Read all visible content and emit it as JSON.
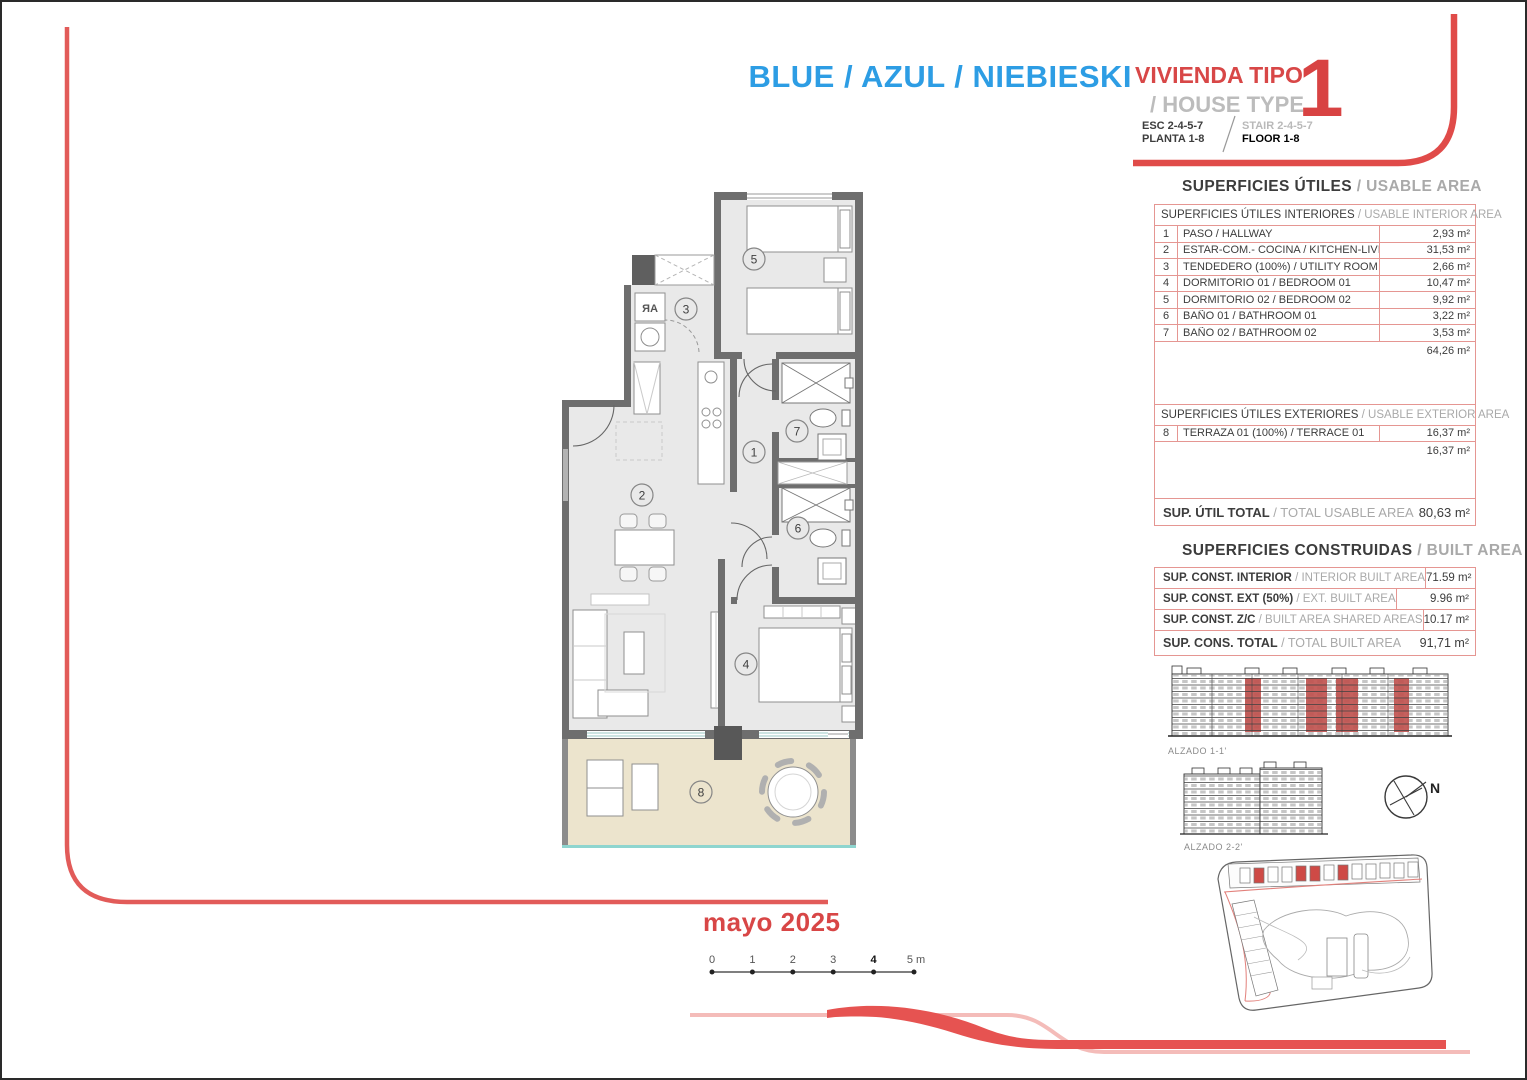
{
  "header": {
    "project_name": "BLUE / AZUL / NIEBIESKI",
    "dwelling_type_es": "VIVIENDA TIPO",
    "dwelling_type_en": "/ HOUSE TYPE",
    "esc": "ESC 2-4-5-7",
    "planta": "PLANTA 1-8",
    "stair": "STAIR 2-4-5-7",
    "floor": "FLOOR 1-8",
    "type_number": "1"
  },
  "usable": {
    "title_es": "SUPERFICIES ÚTILES",
    "title_en": "/ USABLE AREA",
    "interior_header_es": "SUPERFICIES ÚTILES INTERIORES",
    "interior_header_en": "/ USABLE INTERIOR AREA",
    "rows": [
      {
        "n": "1",
        "label": "PASO / HALLWAY",
        "area": "2,93 m²"
      },
      {
        "n": "2",
        "label": "ESTAR-COM.- COCINA / KITCHEN-LIVING",
        "area": "31,53 m²"
      },
      {
        "n": "3",
        "label": "TENDEDERO (100%) / UTILITY ROOM",
        "area": "2,66 m²"
      },
      {
        "n": "4",
        "label": "DORMITORIO 01 / BEDROOM 01",
        "area": "10,47 m²"
      },
      {
        "n": "5",
        "label": "DORMITORIO 02 / BEDROOM 02",
        "area": "9,92 m²"
      },
      {
        "n": "6",
        "label": "BAÑO 01 / BATHROOM 01",
        "area": "3,22 m²"
      },
      {
        "n": "7",
        "label": "BAÑO 02 / BATHROOM 02",
        "area": "3,53 m²"
      }
    ],
    "interior_subtotal": "64,26 m²",
    "exterior_header_es": "SUPERFICIES ÚTILES EXTERIORES",
    "exterior_header_en": "/ USABLE EXTERIOR AREA",
    "exterior_rows": [
      {
        "n": "8",
        "label": "TERRAZA 01 (100%) / TERRACE 01",
        "area": "16,37 m²"
      }
    ],
    "exterior_subtotal": "16,37 m²",
    "total_label_es": "SUP. ÚTIL TOTAL",
    "total_label_en": "/ TOTAL USABLE AREA",
    "total_value": "80,63 m²"
  },
  "built": {
    "title_es": "SUPERFICIES CONSTRUIDAS",
    "title_en": "/ BUILT AREA",
    "rows": [
      {
        "label_es": "SUP. CONST. INTERIOR",
        "label_en": "/ INTERIOR BUILT AREA",
        "area": "71.59 m²"
      },
      {
        "label_es": "SUP. CONST. EXT (50%)",
        "label_en": "/ EXT. BUILT AREA",
        "area": "9.96 m²"
      },
      {
        "label_es": "SUP. CONST. Z/C",
        "label_en": "/ BUILT AREA SHARED AREAS",
        "area": "10.17 m²"
      }
    ],
    "total_label_es": "SUP. CONS. TOTAL",
    "total_label_en": "/ TOTAL BUILT AREA",
    "total_value": "91,71 m²"
  },
  "elevations": {
    "alzado_1": "ALZADO 1-1'",
    "alzado_2": "ALZADO 2-2'"
  },
  "compass_label": "N",
  "issue_date": "mayo 2025",
  "scalebar": {
    "labels": [
      "0",
      "1",
      "2",
      "3",
      "4",
      "5 m"
    ]
  },
  "plan": {
    "rooms": [
      "1",
      "2",
      "3",
      "4",
      "5",
      "6",
      "7",
      "8"
    ],
    "washer": "AR"
  },
  "colors": {
    "accent_red": "#d84747",
    "title_blue": "#2d9de4",
    "muted_gray": "#a9a9a9",
    "table_border": "#e59692",
    "wall_gray": "#6e6e6e",
    "terrace_beige": "#ece4cd"
  }
}
